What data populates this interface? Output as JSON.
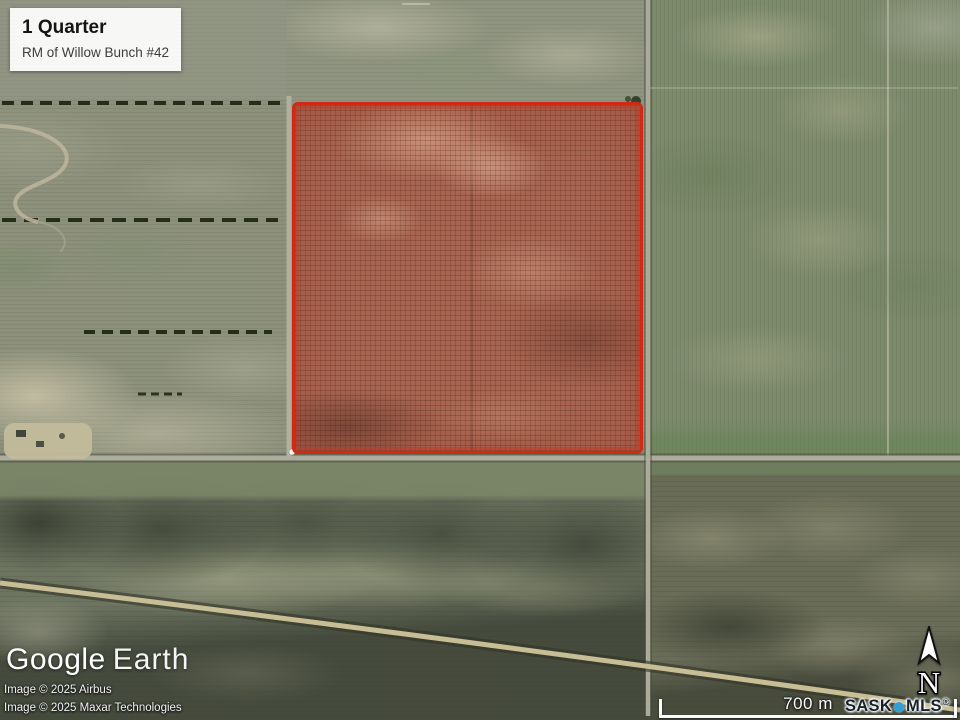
{
  "map": {
    "info_box": {
      "title": "1 Quarter",
      "subtitle": "RM of Willow Bunch #42"
    },
    "branding": {
      "google": "Google",
      "earth": "Earth"
    },
    "attribution": {
      "line1": "Image © 2025 Airbus",
      "line2": "Image © 2025 Maxar Technologies"
    },
    "scale_bar": {
      "label": "700 m"
    },
    "sask_mls": {
      "sask": "SASK",
      "mls": "MLS",
      "registered": "®"
    },
    "compass": {
      "north": "N"
    },
    "icons": {
      "north_arrow": "⬆",
      "mls_dot": "●"
    },
    "colors": {
      "parcel_border": "#cf2a16",
      "parcel_fill": "rgba(187,62,42,0.55)",
      "mls_dot": "#2e9fd9",
      "mls_text": "#15222e"
    }
  }
}
